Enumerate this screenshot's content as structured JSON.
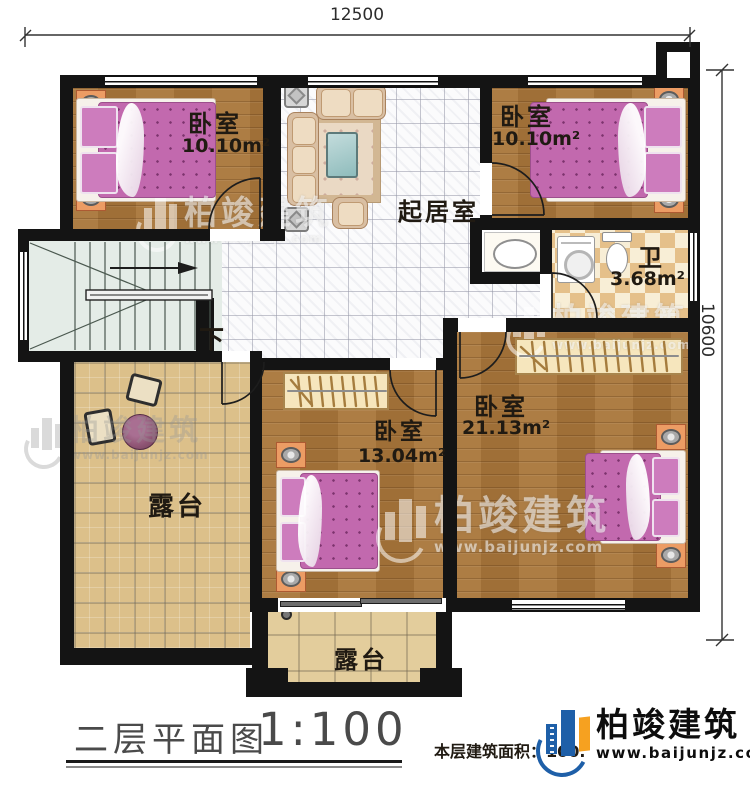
{
  "palette": {
    "brand_blue": "#1e5fa8",
    "brand_orange": "#f6a120",
    "wall": "#141414",
    "wood_floor": "#a9763a",
    "checker_tan": "#e5c08a",
    "terrace_paving": "#dcc08a",
    "bed_pink": "#c269ae",
    "stairs": "#e4ece7"
  },
  "dimensions": {
    "width_mm": "12500",
    "height_mm": "10600"
  },
  "rooms": {
    "bedroom_tl": {
      "name": "卧室",
      "area": "10.10m²"
    },
    "bedroom_tr": {
      "name": "卧室",
      "area": "10.10m²"
    },
    "living": {
      "name": "起居室"
    },
    "bath": {
      "name": "卫",
      "area": "3.68m²"
    },
    "bedroom_right": {
      "name": "卧室",
      "area": "21.13m²"
    },
    "bedroom_mid": {
      "name": "卧室",
      "area": "13.04m²"
    },
    "terrace_left": {
      "name": "露台"
    },
    "terrace_bottom": {
      "name": "露台"
    }
  },
  "stairs": {
    "direction": "下"
  },
  "footer": {
    "plan_title": "二层平面图",
    "scale": "1:100",
    "area_label": "本层建筑面积：100."
  },
  "brand": {
    "name": "柏竣建筑",
    "url": "www.baijunjz.com"
  }
}
